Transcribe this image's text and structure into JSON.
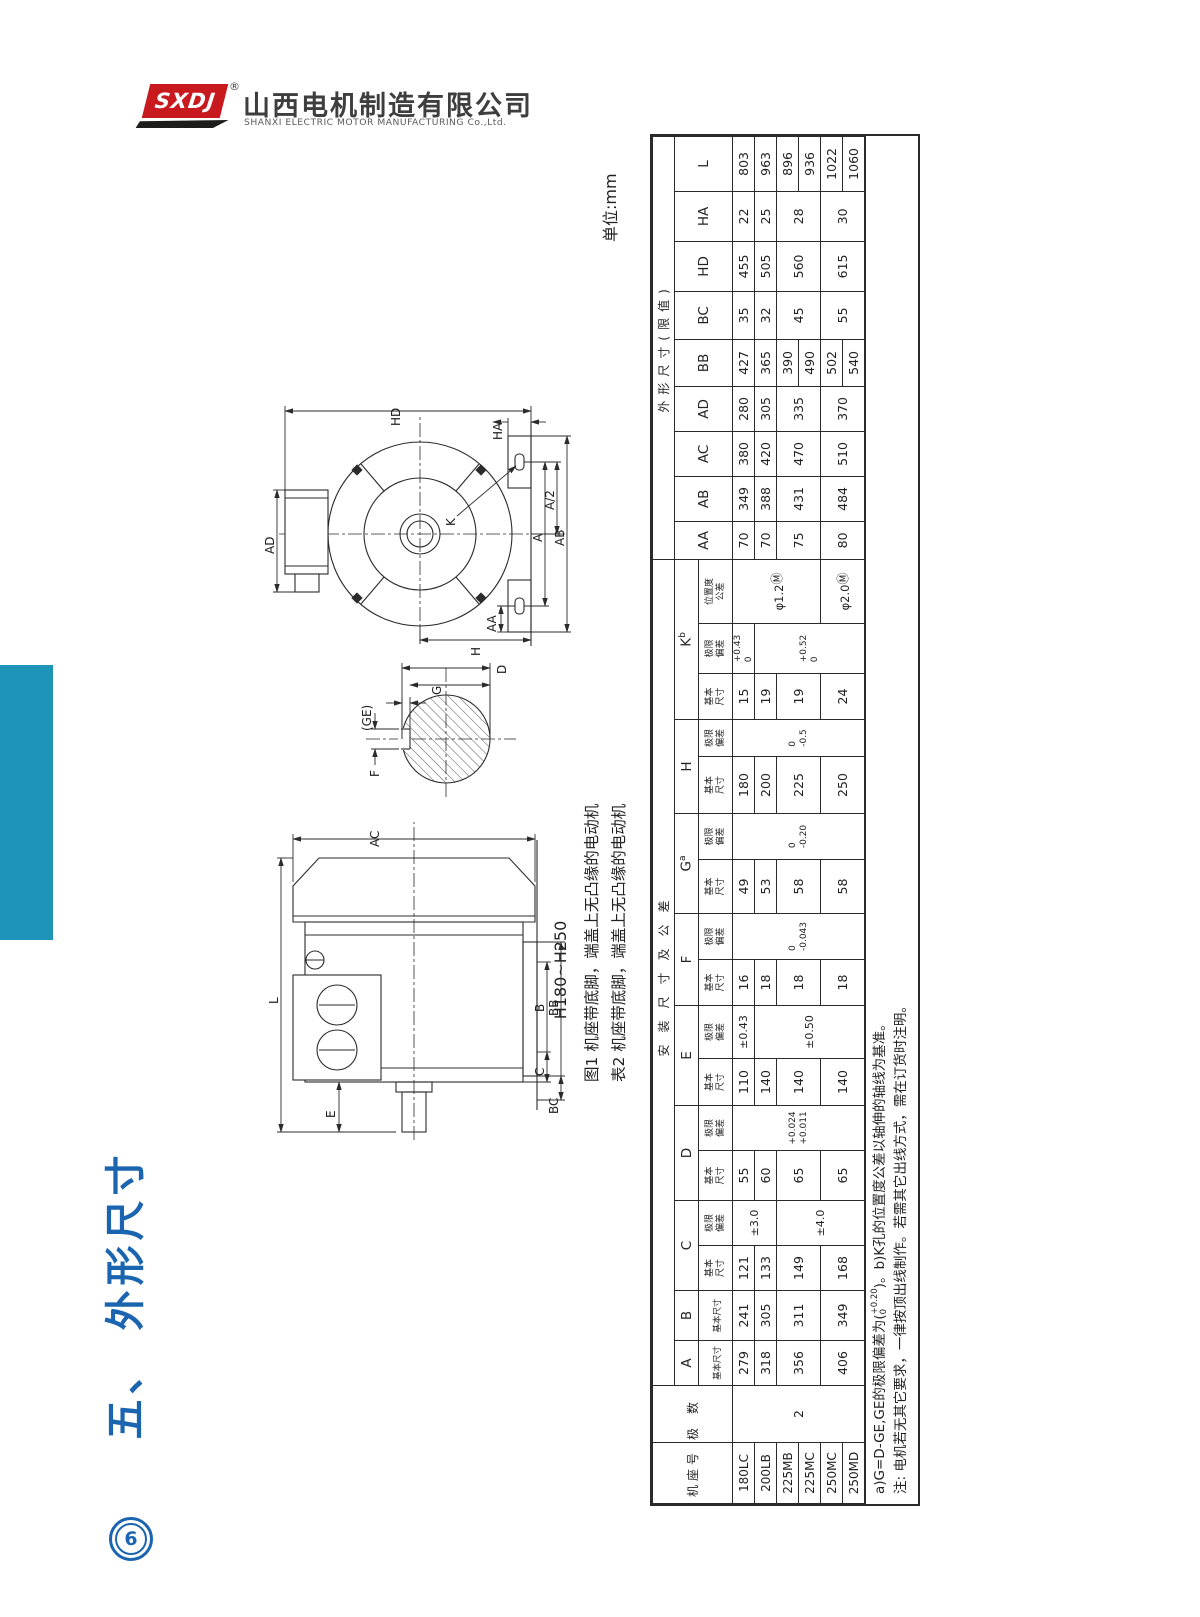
{
  "logo": {
    "brand": "SXDJ",
    "reg": "®",
    "company_cn": "山西电机制造有限公司",
    "company_en": "SHANXI ELECTRIC MOTOR MANUFACTURING Co.,Ltd."
  },
  "page": {
    "section_title": "五、 外形尺寸",
    "page_num": "6",
    "unit": "单位:mm",
    "range": "H180~H250",
    "caption_fig": "图1 机座带底脚，端盖上无凸缘的电动机",
    "caption_tab": "表2 机座带底脚，端盖上无凸缘的电动机"
  },
  "colors": {
    "accent_blue": "#1a64b0",
    "teal_bar": "#1d94b8",
    "logo_red": "#c8191f",
    "line_dark": "#2b2b2b"
  },
  "drawings": {
    "side": {
      "labels": {
        "L": "L",
        "AC": "AC",
        "E": "E",
        "C": "C",
        "B": "B",
        "BC": "BC",
        "BB": "BB"
      }
    },
    "section": {
      "labels": {
        "F": "F",
        "GE": "(GE)",
        "G": "G",
        "D": "D"
      }
    },
    "front": {
      "labels": {
        "AD": "AD",
        "HD": "HD",
        "HA": "HA",
        "K": "K",
        "A": "A",
        "A2": "A/2",
        "AA": "AA",
        "AB": "AB",
        "H": "H"
      }
    }
  },
  "table": {
    "headers": {
      "frame": "机座号",
      "poles": "极数",
      "install": "安装尺寸及公差",
      "overall": "外形尺寸(限值)",
      "basic": "基本尺寸",
      "dev": "极限偏差",
      "pos": "位置度公差",
      "A": "A",
      "B": "B",
      "C": "C",
      "D": "D",
      "E": "E",
      "F": "F",
      "G": "G",
      "H": "H",
      "K": "K",
      "sup_a": "a",
      "sup_b": "b",
      "AA": "AA",
      "AB": "AB",
      "AC": "AC",
      "AD": "AD",
      "BB": "BB",
      "BC": "BC",
      "HD": "HD",
      "HA": "HA",
      "L": "L"
    },
    "frames": [
      "180LC",
      "200LB",
      "225MB",
      "225MC",
      "250MC",
      "250MD"
    ],
    "poles": "2",
    "A": [
      "279",
      "318",
      "356",
      "406"
    ],
    "B": [
      "241",
      "305",
      "311",
      "349"
    ],
    "C": {
      "basic": [
        "121",
        "133",
        "149",
        "168"
      ],
      "dev": [
        "±3.0",
        "±4.0"
      ]
    },
    "D": {
      "basic": [
        "55",
        "60",
        "65",
        "65"
      ],
      "dev_top": "+0.024",
      "dev_bot": "+0.011"
    },
    "E": {
      "basic": [
        "110",
        "140",
        "140",
        "140"
      ],
      "dev": [
        "±0.43",
        "±0.50"
      ]
    },
    "F": {
      "basic": [
        "16",
        "18",
        "18",
        "18"
      ],
      "dev_top": "0",
      "dev_bot": "-0.043"
    },
    "G": {
      "basic": [
        "49",
        "53",
        "58",
        "58"
      ],
      "dev_top": "0",
      "dev_bot": "-0.20"
    },
    "H": {
      "basic": [
        "180",
        "200",
        "225",
        "250"
      ],
      "dev_top": "0",
      "dev_bot": "-0.5"
    },
    "K": {
      "basic": [
        "15",
        "19",
        "19",
        "24"
      ],
      "dev1_top": "+0.43",
      "dev1_bot": "0",
      "dev2_top": "+0.52",
      "dev2_bot": "0",
      "pos": [
        "φ1.2",
        "φ2.0"
      ],
      "pos_m": "Ⓜ"
    },
    "AA": [
      "70",
      "70",
      "75",
      "80"
    ],
    "AB": [
      "349",
      "388",
      "431",
      "484"
    ],
    "AC": [
      "380",
      "420",
      "470",
      "510"
    ],
    "AD": [
      "280",
      "305",
      "335",
      "370"
    ],
    "BB": [
      "427",
      "365",
      "390",
      "490",
      "502",
      "540"
    ],
    "BC": [
      "35",
      "32",
      "45",
      "55"
    ],
    "HD": [
      "455",
      "505",
      "560",
      "615"
    ],
    "HA": [
      "22",
      "25",
      "28",
      "30"
    ],
    "L": [
      "803",
      "963",
      "896",
      "936",
      "1022",
      "1060"
    ],
    "notes": {
      "n1a": "a)G=D-GE,GE的极限偏差为(",
      "n1_top": "+0.20",
      "n1_bot": "0",
      "n1b": ")。b)K孔的位置度公差以轴伸的轴线为基准。",
      "n2": "注: 电机若无其它要求，一律按顶出线制作。若需其它出线方式，需在订货时注明。"
    }
  }
}
